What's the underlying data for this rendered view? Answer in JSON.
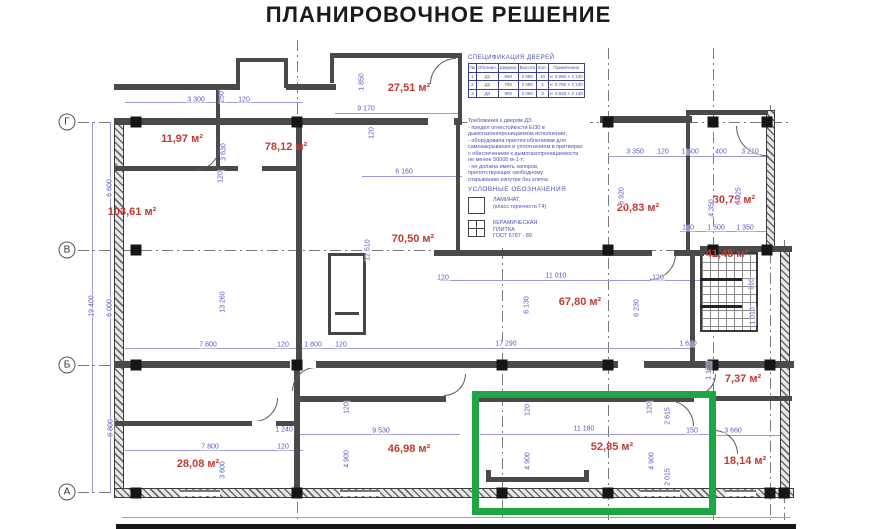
{
  "title": "ПЛАНИРОВОЧНОЕ РЕШЕНИЕ",
  "colors": {
    "highlight_green": "#1fa644",
    "dimension_blue": "#5a5ac8",
    "room_red": "#c23a34"
  },
  "spec_table": {
    "title": "СПЕЦИФИКАЦИЯ ДВЕРЕЙ",
    "col_headers": [
      "№",
      "Обознач.",
      "Ширина",
      "Высота",
      "Кол.",
      "Примечание"
    ],
    "rows": [
      [
        "1",
        "Д1",
        "950",
        "2 080",
        "10",
        "н: 0,980 × 2 130"
      ],
      [
        "2",
        "Д2",
        "750",
        "2 080",
        "4",
        "н: 0,780 × 2 130"
      ],
      [
        "3",
        "Д3",
        "900",
        "2 080",
        "3",
        "н: 0,930 × 2 130"
      ]
    ]
  },
  "notes": {
    "title": "Требования к дверям Д3:",
    "lines": [
      "- предел огнестойкости EI30 в",
      "дымогазонепроницаемом исполнении;",
      "- оборудована приспособлениями для",
      "самозакрывания и уплотнением в притворах",
      "с обеспечением к дымогазопроницаемости",
      "не менее 50000 м-1·т;",
      "- не должна иметь запоров,",
      "препятствующих свободному",
      "открыванию изнутри без ключа"
    ]
  },
  "legend": {
    "title": "УСЛОВНЫЕ ОБОЗНАЧЕНИЯ",
    "items": [
      {
        "symbol": "laminate-swatch",
        "label": "ЛАМИНАТ,\n(класс горючести Г4)"
      },
      {
        "symbol": "ceramic-tile-swatch",
        "label": "КЕРАМИЧЕСКАЯ\nПЛИТКА\nГОСТ 6787 - 89"
      }
    ]
  },
  "axis_rows": [
    {
      "text": "Г",
      "x": 67,
      "y": 122
    },
    {
      "text": "В",
      "x": 67,
      "y": 250
    },
    {
      "text": "Б",
      "x": 67,
      "y": 365
    },
    {
      "text": "А",
      "x": 67,
      "y": 492
    }
  ],
  "rooms": [
    {
      "text": "27,51 м²",
      "x": 409,
      "y": 88
    },
    {
      "text": "11,97 м²",
      "x": 182,
      "y": 139
    },
    {
      "text": "78,12 м²",
      "x": 286,
      "y": 147
    },
    {
      "text": "103,61 м²",
      "x": 132,
      "y": 212
    },
    {
      "text": "70,50 м²",
      "x": 413,
      "y": 239
    },
    {
      "text": "20,83 м²",
      "x": 638,
      "y": 208
    },
    {
      "text": "30,79 м²",
      "x": 734,
      "y": 200
    },
    {
      "text": "41,45 м²",
      "x": 727,
      "y": 254
    },
    {
      "text": "67,80 м²",
      "x": 580,
      "y": 302
    },
    {
      "text": "7,37 м²",
      "x": 743,
      "y": 379
    },
    {
      "text": "28,08 м²",
      "x": 198,
      "y": 464
    },
    {
      "text": "46,98 м²",
      "x": 409,
      "y": 449
    },
    {
      "text": "52,85 м²",
      "x": 612,
      "y": 447
    },
    {
      "text": "18,14 м²",
      "x": 745,
      "y": 461
    }
  ],
  "dimensions": [
    {
      "text": "3 300",
      "x": 196,
      "y": 100
    },
    {
      "text": "120",
      "x": 244,
      "y": 100
    },
    {
      "text": "9 170",
      "x": 366,
      "y": 109
    },
    {
      "text": "6 160",
      "x": 404,
      "y": 172
    },
    {
      "text": "1 850",
      "x": 362,
      "y": 82,
      "rot": -90
    },
    {
      "text": "250",
      "x": 222,
      "y": 97,
      "rot": -90
    },
    {
      "text": "3 630",
      "x": 224,
      "y": 152,
      "rot": -90
    },
    {
      "text": "120",
      "x": 221,
      "y": 177,
      "rot": -90
    },
    {
      "text": "120",
      "x": 372,
      "y": 133,
      "rot": -90
    },
    {
      "text": "3 350",
      "x": 635,
      "y": 152
    },
    {
      "text": "120",
      "x": 663,
      "y": 152
    },
    {
      "text": "1 500",
      "x": 690,
      "y": 152
    },
    {
      "text": "400",
      "x": 721,
      "y": 152
    },
    {
      "text": "3 210",
      "x": 750,
      "y": 152
    },
    {
      "text": "6 920",
      "x": 622,
      "y": 196,
      "rot": -90
    },
    {
      "text": "4 350",
      "x": 712,
      "y": 208,
      "rot": -90
    },
    {
      "text": "6 025",
      "x": 739,
      "y": 196,
      "rot": -90
    },
    {
      "text": "150",
      "x": 688,
      "y": 228
    },
    {
      "text": "1 500",
      "x": 716,
      "y": 228
    },
    {
      "text": "1 350",
      "x": 745,
      "y": 228
    },
    {
      "text": "120",
      "x": 443,
      "y": 278
    },
    {
      "text": "11 010",
      "x": 556,
      "y": 276
    },
    {
      "text": "120",
      "x": 658,
      "y": 278
    },
    {
      "text": "6 130",
      "x": 527,
      "y": 305,
      "rot": -90
    },
    {
      "text": "6 230",
      "x": 637,
      "y": 308,
      "rot": -90
    },
    {
      "text": "12 510",
      "x": 368,
      "y": 250,
      "rot": -90
    },
    {
      "text": "13 260",
      "x": 223,
      "y": 302,
      "rot": -90
    },
    {
      "text": "17 290",
      "x": 506,
      "y": 344
    },
    {
      "text": "1 620",
      "x": 688,
      "y": 344
    },
    {
      "text": "7 800",
      "x": 208,
      "y": 345
    },
    {
      "text": "120",
      "x": 283,
      "y": 345
    },
    {
      "text": "1 800",
      "x": 313,
      "y": 345
    },
    {
      "text": "120",
      "x": 341,
      "y": 345
    },
    {
      "text": "910",
      "x": 752,
      "y": 284,
      "rot": -90
    },
    {
      "text": "1 010",
      "x": 753,
      "y": 316,
      "rot": -90
    },
    {
      "text": "7 800",
      "x": 210,
      "y": 447
    },
    {
      "text": "120",
      "x": 283,
      "y": 447
    },
    {
      "text": "1 240",
      "x": 284,
      "y": 430
    },
    {
      "text": "3 600",
      "x": 223,
      "y": 470,
      "rot": -90
    },
    {
      "text": "9 530",
      "x": 381,
      "y": 431
    },
    {
      "text": "4 900",
      "x": 347,
      "y": 459,
      "rot": -90
    },
    {
      "text": "120",
      "x": 347,
      "y": 408,
      "rot": -90
    },
    {
      "text": "11 180",
      "x": 584,
      "y": 429
    },
    {
      "text": "120",
      "x": 528,
      "y": 410,
      "rot": -90
    },
    {
      "text": "4 900",
      "x": 528,
      "y": 461,
      "rot": -90
    },
    {
      "text": "120",
      "x": 650,
      "y": 408,
      "rot": -90
    },
    {
      "text": "4 900",
      "x": 652,
      "y": 461,
      "rot": -90
    },
    {
      "text": "2 615",
      "x": 668,
      "y": 416,
      "rot": -90
    },
    {
      "text": "2 015",
      "x": 668,
      "y": 477,
      "rot": -90
    },
    {
      "text": "150",
      "x": 692,
      "y": 431
    },
    {
      "text": "3 660",
      "x": 733,
      "y": 431
    },
    {
      "text": "1 150",
      "x": 709,
      "y": 371,
      "rot": -90
    },
    {
      "text": "6 600",
      "x": 110,
      "y": 188,
      "rot": -90
    },
    {
      "text": "6 000",
      "x": 110,
      "y": 308,
      "rot": -90
    },
    {
      "text": "6 800",
      "x": 111,
      "y": 428,
      "rot": -90
    },
    {
      "text": "19 400",
      "x": 92,
      "y": 306,
      "rot": -90
    }
  ]
}
